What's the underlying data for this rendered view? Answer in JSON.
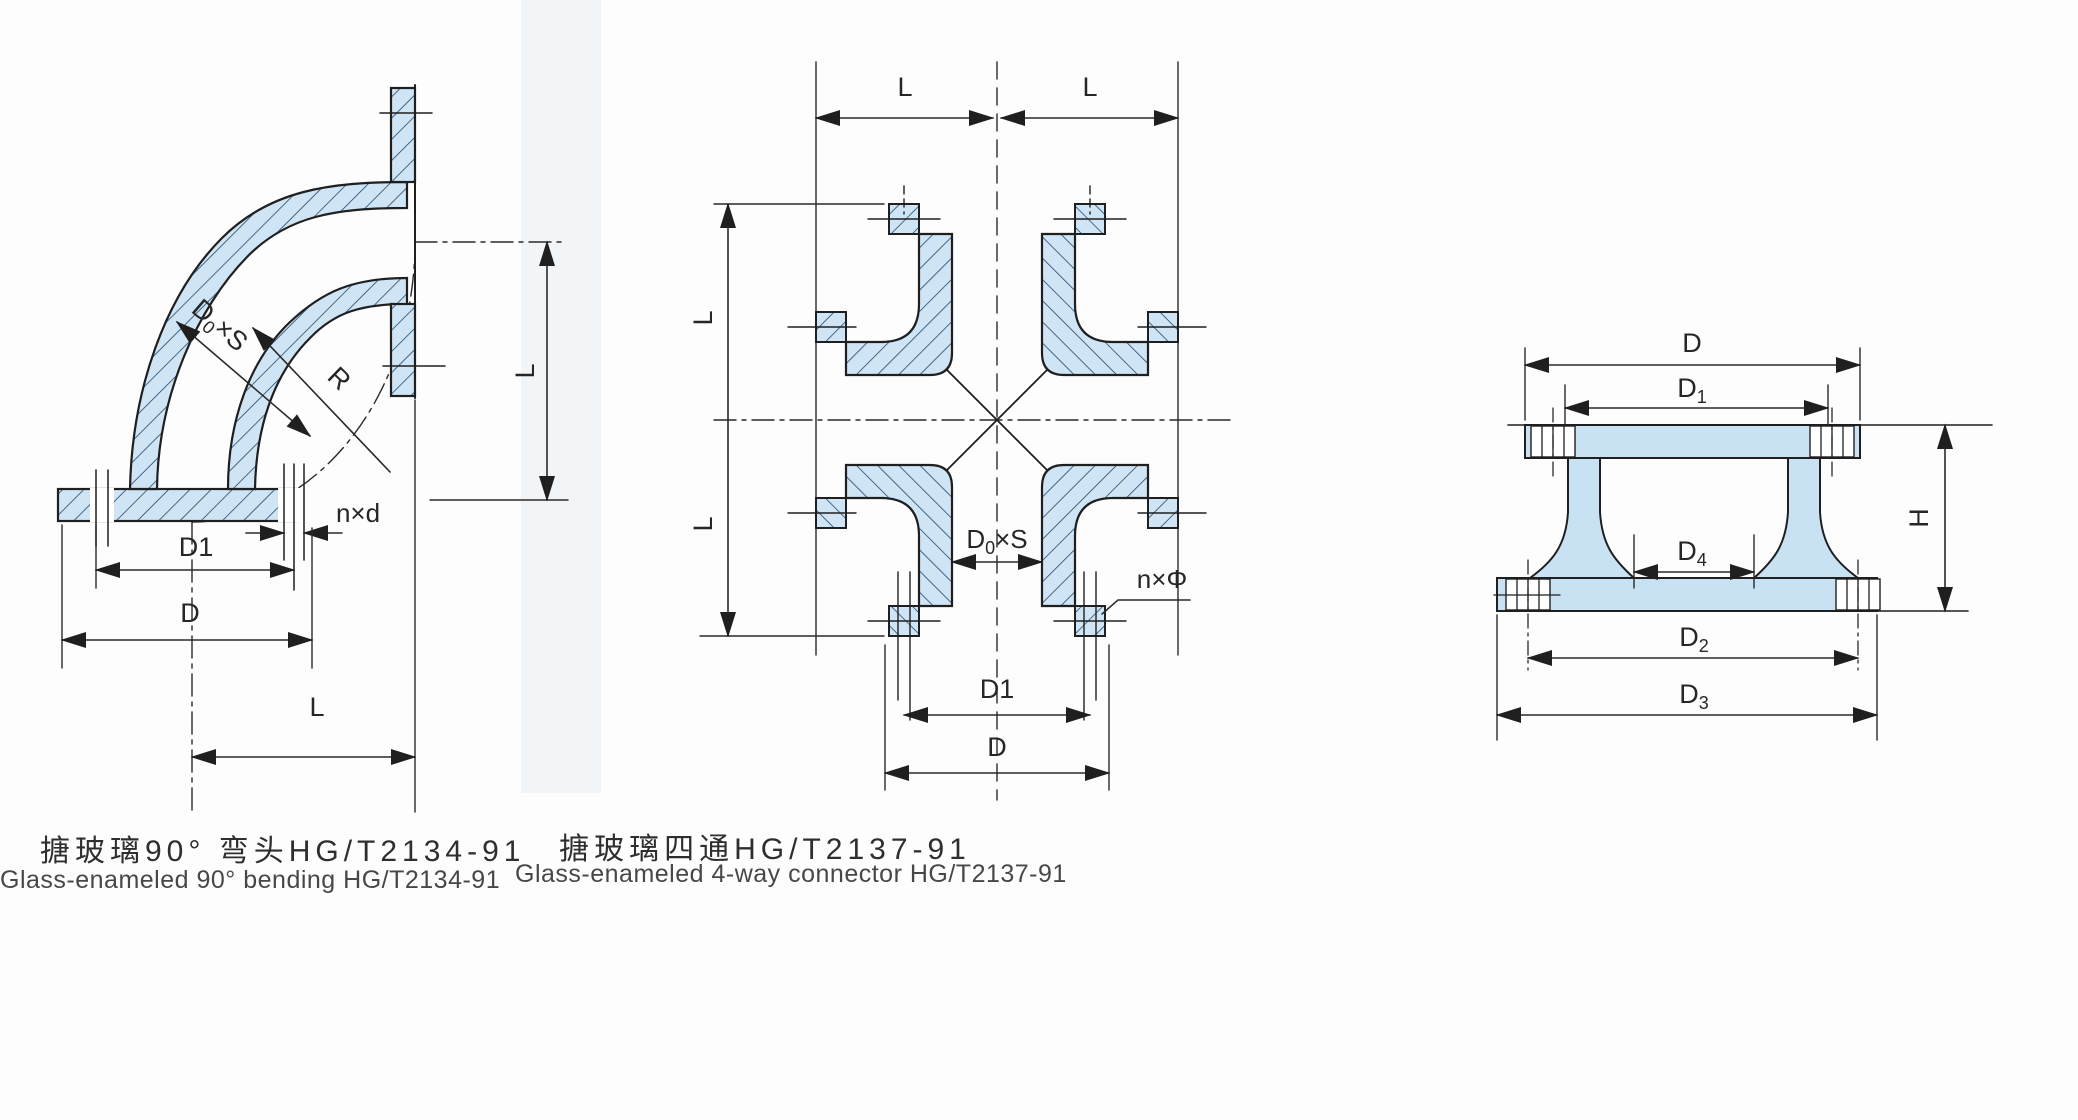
{
  "page": {
    "background": "#fdfdfd"
  },
  "colors": {
    "wall_fill": "#cfe5f6",
    "wall_fill_right": "#c8e1f3",
    "hatch_line": "#23476b",
    "outline": "#1f1f1f",
    "dim_line": "#2a2a2a",
    "band": "#e9eef3"
  },
  "elbow": {
    "caption_zh": "搪玻璃90° 弯头HG/T2134-91",
    "caption_en": "Glass-enameled 90° bending HG/T2134-91",
    "labels": {
      "pipe_od": {
        "main": "D",
        "sub": "0",
        "rest": "×S"
      },
      "bend_radius": "R",
      "bolt_holes": "n×d",
      "bolt_circle": "D1",
      "flange_od": "D",
      "length_bottom": "L",
      "length_right": "L"
    }
  },
  "cross": {
    "caption_zh": "搪玻璃四通HG/T2137-91",
    "caption_en": "Glass-enameled 4-way connector HG/T2137-91",
    "labels": {
      "l_top_left": "L",
      "l_top_right": "L",
      "l_left_upper": "L",
      "l_left_lower": "L",
      "pipe_od": {
        "main": "D",
        "sub": "0",
        "rest": "×S"
      },
      "bolt_holes": "n×Φ",
      "bolt_circle": "D1",
      "flange_od": "D"
    }
  },
  "flange_section": {
    "labels": {
      "d": "D",
      "d1": {
        "main": "D",
        "sub": "1"
      },
      "h": "H",
      "d4": {
        "main": "D",
        "sub": "4"
      },
      "d2": {
        "main": "D",
        "sub": "2"
      },
      "d3": {
        "main": "D",
        "sub": "3"
      }
    }
  }
}
